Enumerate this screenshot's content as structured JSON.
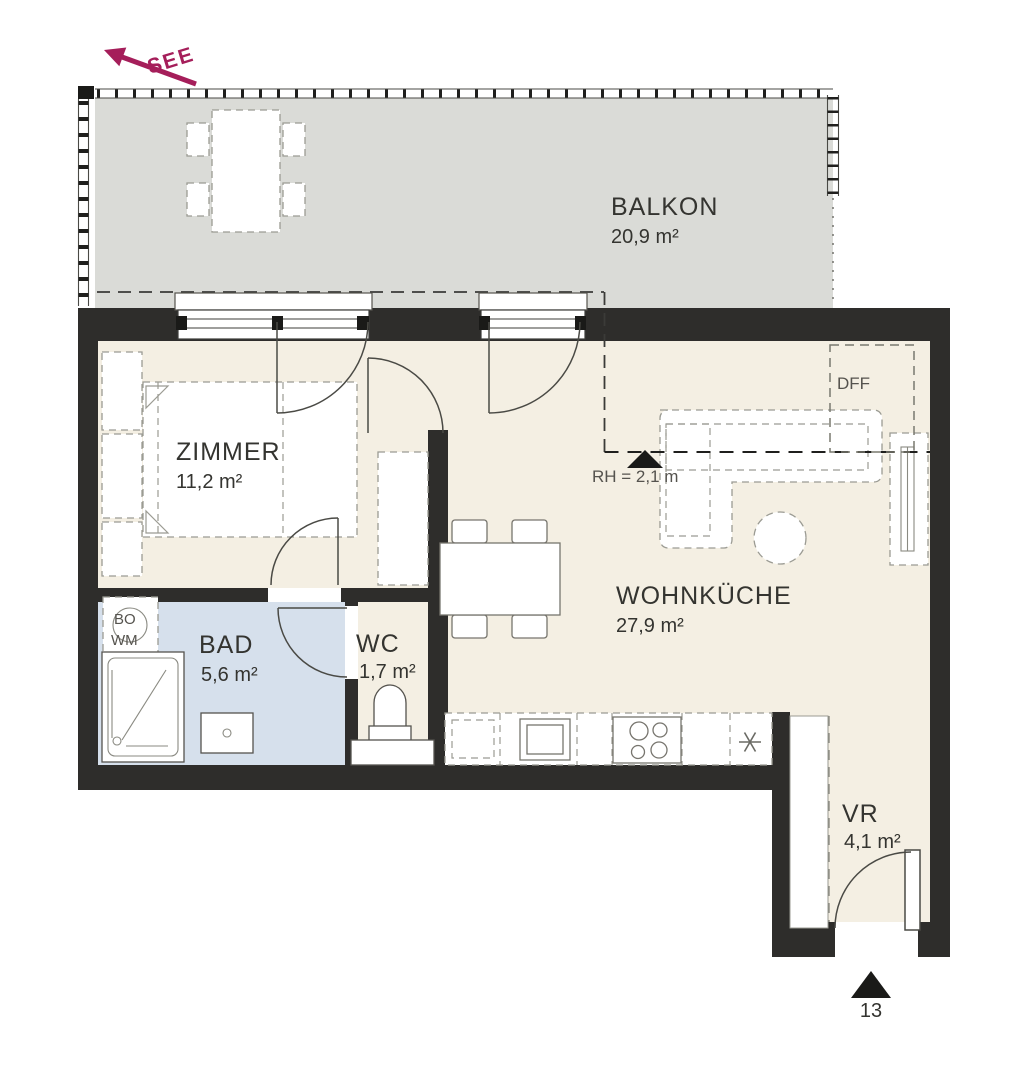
{
  "plan_title": "floor-plan",
  "colors": {
    "wall": "#2e2d2b",
    "floor": "#f4efe3",
    "bathroom_floor": "#d6e0ec",
    "balcony_floor": "#dadbd7",
    "accent": "#a51e5a"
  },
  "compass": {
    "label": "SEE"
  },
  "rooms": {
    "balkon": {
      "name": "BALKON",
      "area": "20,9 m²"
    },
    "zimmer": {
      "name": "ZIMMER",
      "area": "11,2 m²"
    },
    "wohnkueche": {
      "name": "WOHNKÜCHE",
      "area": "27,9 m²"
    },
    "bad": {
      "name": "BAD",
      "area": "5,6 m²"
    },
    "wc": {
      "name": "WC",
      "area": "1,7 m²"
    },
    "vr": {
      "name": "VR",
      "area": "4,1 m²"
    }
  },
  "annotations": {
    "roof_window": "DFF",
    "room_height": "RH = 2,1 m",
    "boiler": "BO",
    "washing_machine": "WM",
    "unit_number": "13",
    "fridge_icon": "✳"
  }
}
